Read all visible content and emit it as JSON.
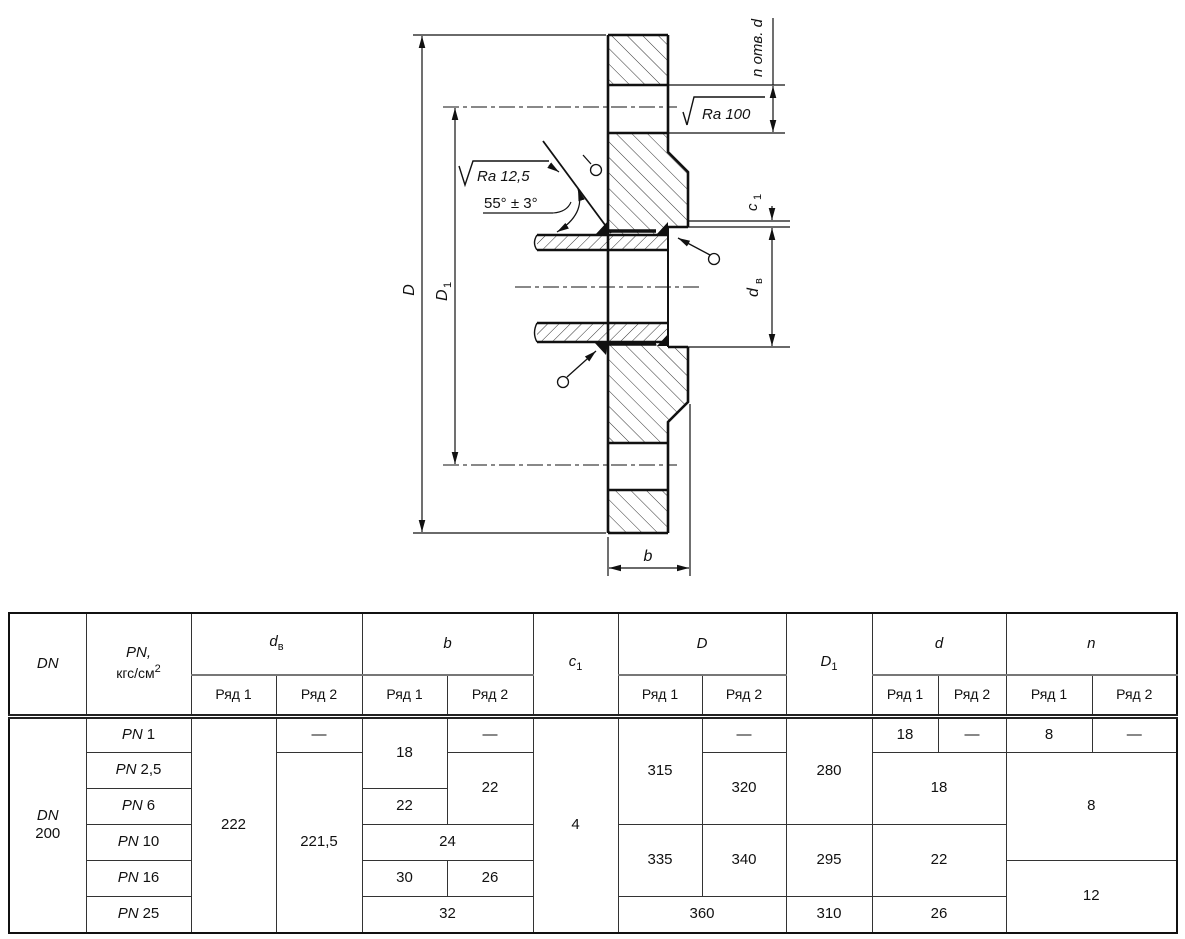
{
  "drawing": {
    "labels": {
      "outer_diameter": "D",
      "bolt_circle_main": "D",
      "bolt_circle_sub": "1",
      "holes_note": "n отв. d",
      "roughness_face": "Ra 100",
      "roughness_bevel": "Ra 12,5",
      "bevel_angle": "55° ± 3°",
      "face_step_main": "c",
      "face_step_sub": "1",
      "bore_main": "d",
      "bore_sub": "в",
      "thickness": "b"
    }
  },
  "table": {
    "headers": {
      "dn": "DN",
      "pn_main": "PN,",
      "pn_unit": "кгс/см",
      "pn_sup": "2",
      "dv_main": "d",
      "dv_sub": "в",
      "b": "b",
      "c1_main": "c",
      "c1_sub": "1",
      "D": "D",
      "D1_main": "D",
      "D1_sub": "1",
      "d": "d",
      "n": "n",
      "row1": "Ряд 1",
      "row2": "Ряд 2"
    },
    "dn_line1": "DN",
    "dn_line2": "200",
    "pn_prefix": "PN",
    "pn_values": [
      "1",
      "2,5",
      "6",
      "10",
      "16",
      "25"
    ],
    "cells": {
      "dash": "—",
      "dv_r1": "222",
      "dv_r2": "221,5",
      "b_r1_12": "18",
      "b_r2_23": "22",
      "b_r1_3": "22",
      "b_4": "24",
      "b_r1_5": "30",
      "b_r2_5": "26",
      "b_6": "32",
      "c1": "4",
      "D_r1_123": "315",
      "D_r2_23": "320",
      "D_r1_45": "335",
      "D_r2_45": "340",
      "D_6": "360",
      "D1_123": "280",
      "D1_45": "295",
      "D1_6": "310",
      "d_r1_1": "18",
      "d_23": "18",
      "d_45": "22",
      "d_6": "26",
      "n_r1_1": "8",
      "n_234": "8",
      "n_56": "12"
    }
  }
}
